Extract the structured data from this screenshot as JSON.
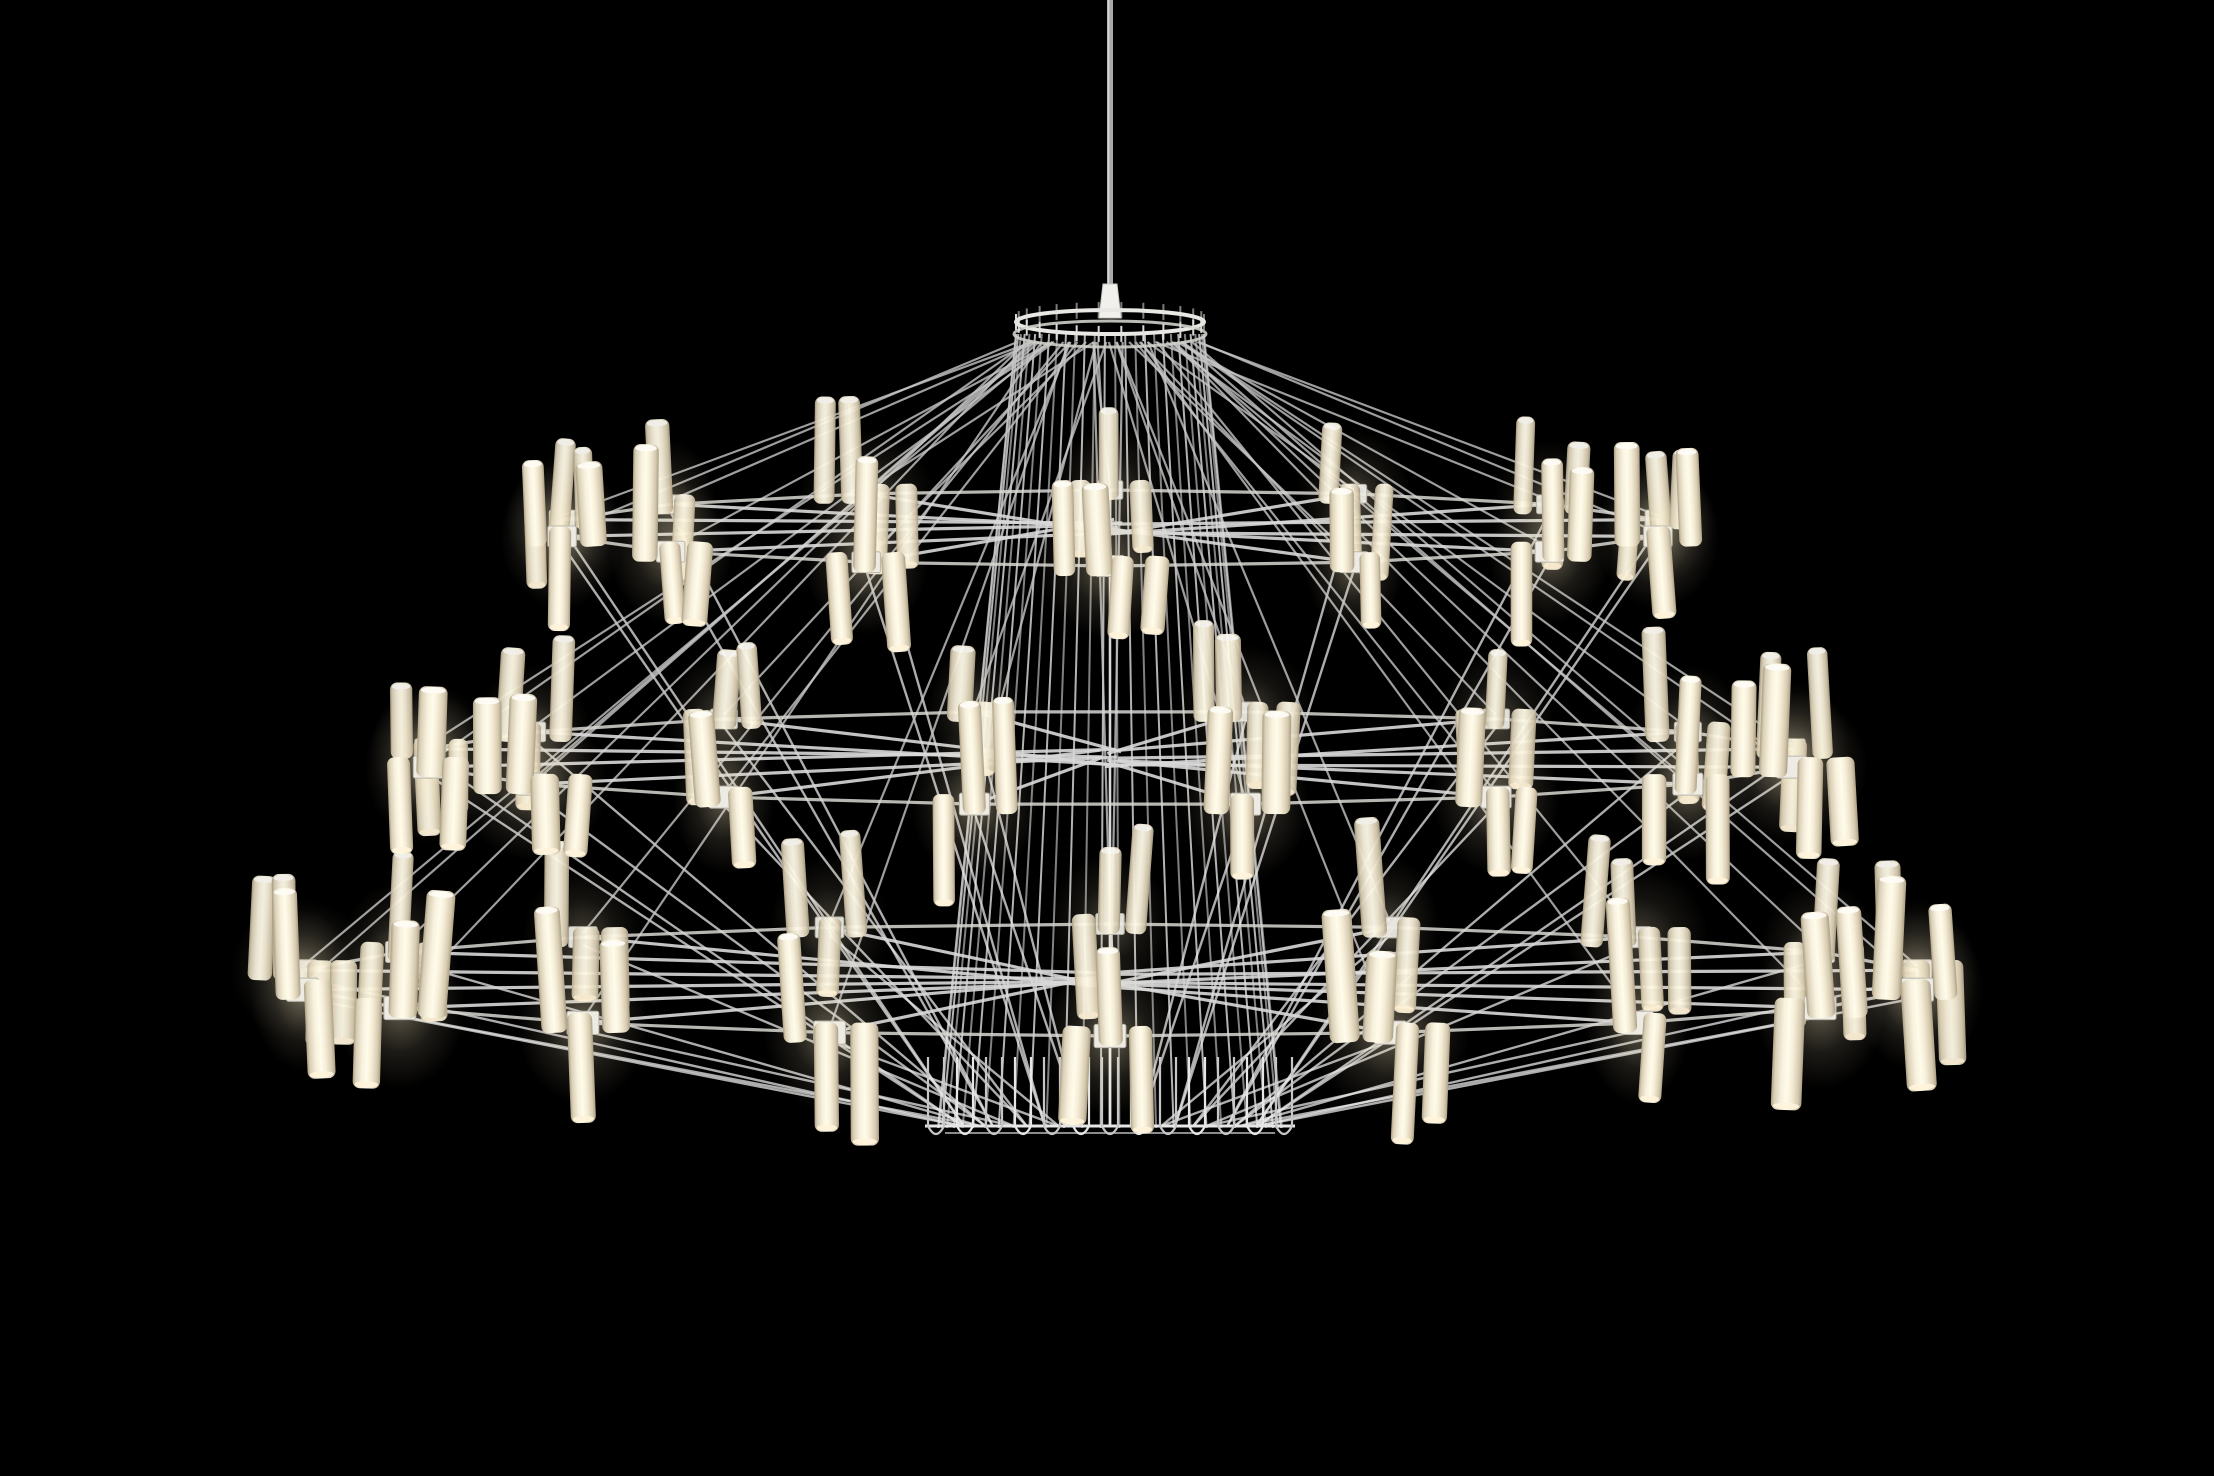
{
  "scene": {
    "kind": "product-photograph",
    "subject": "three-tier suspended wire chandelier with glowing tubular LED lamps",
    "image_size": {
      "width": 2214,
      "height": 1476
    },
    "background_color": "#000000",
    "colors": {
      "wire": "#c6c6c6",
      "wire_dim": "#8f8f8f",
      "wire_bright": "#e6e6e6",
      "rail": "#d7d6d1",
      "hub": "#edebe3",
      "hub_border": "#b9b6ab",
      "tube_edge": "#ab9f85",
      "tube_mid": "#f7f0dd",
      "tube_core": "#fffcea",
      "tube_cap_top": "#fdfcf6",
      "tube_cap_bottom": "#fff3da",
      "glow": "#ffeec6",
      "canopy_rim": "#e9e8e4",
      "canopy_band": "#cfcec8",
      "cord": "#a8a8a8",
      "cord_highlight": "#dedede",
      "fitting": "#f1f0ec",
      "fitting_border": "#c9c8c3"
    },
    "center_x": 1110,
    "cord": {
      "from_y": 0,
      "to_y": 292,
      "width": 6
    },
    "fitting": {
      "top_y": 284,
      "bottom_y": 318,
      "top_half_w": 7,
      "bottom_half_w": 11
    },
    "canopy": {
      "ring_y": 322,
      "rx": 94,
      "ry": 12,
      "band_offset": 12,
      "tick_count": 26,
      "tick_len": 16
    },
    "cage": {
      "wire_count": 30,
      "top_y": 334,
      "bottom_y": 1128,
      "top_rx": 94,
      "bottom_rx": 172
    },
    "bottom_assembly": {
      "rail_y": 1126,
      "rail_half_width": 185,
      "loop_y": 1142,
      "hairpin_count": 13,
      "hairpin_spacing": 29,
      "hairpin_half_w": 8,
      "hairpin_rise": 85
    },
    "tiers": [
      {
        "name": "top",
        "hub_y": 528,
        "radius_x": 562,
        "radius_y": 38,
        "clusters": 14,
        "tube_scale": 0.95
      },
      {
        "name": "middle",
        "hub_y": 758,
        "radius_x": 695,
        "radius_y": 47,
        "clusters": 16,
        "tube_scale": 1.0
      },
      {
        "name": "bottom",
        "hub_y": 980,
        "radius_x": 820,
        "radius_y": 56,
        "clusters": 18,
        "tube_scale": 1.06
      }
    ],
    "tube": {
      "base_width": 25,
      "base_height": 106,
      "corner_radius": 7,
      "patterns": [
        [
          "u",
          "d",
          "u"
        ],
        [
          "d",
          "u",
          "u"
        ],
        [
          "u",
          "d"
        ],
        [
          "u",
          "u",
          "d",
          "d"
        ],
        [
          "d",
          "u",
          "d"
        ],
        [
          "u",
          "d",
          "d"
        ]
      ]
    },
    "hub": {
      "width": 30,
      "height": 22
    },
    "wire_style": {
      "cage_width": 2,
      "arm_width": 3.2,
      "guy_top_width": 2.2,
      "guy_bottom_width": 2.4,
      "rail_width": 3.2
    }
  }
}
